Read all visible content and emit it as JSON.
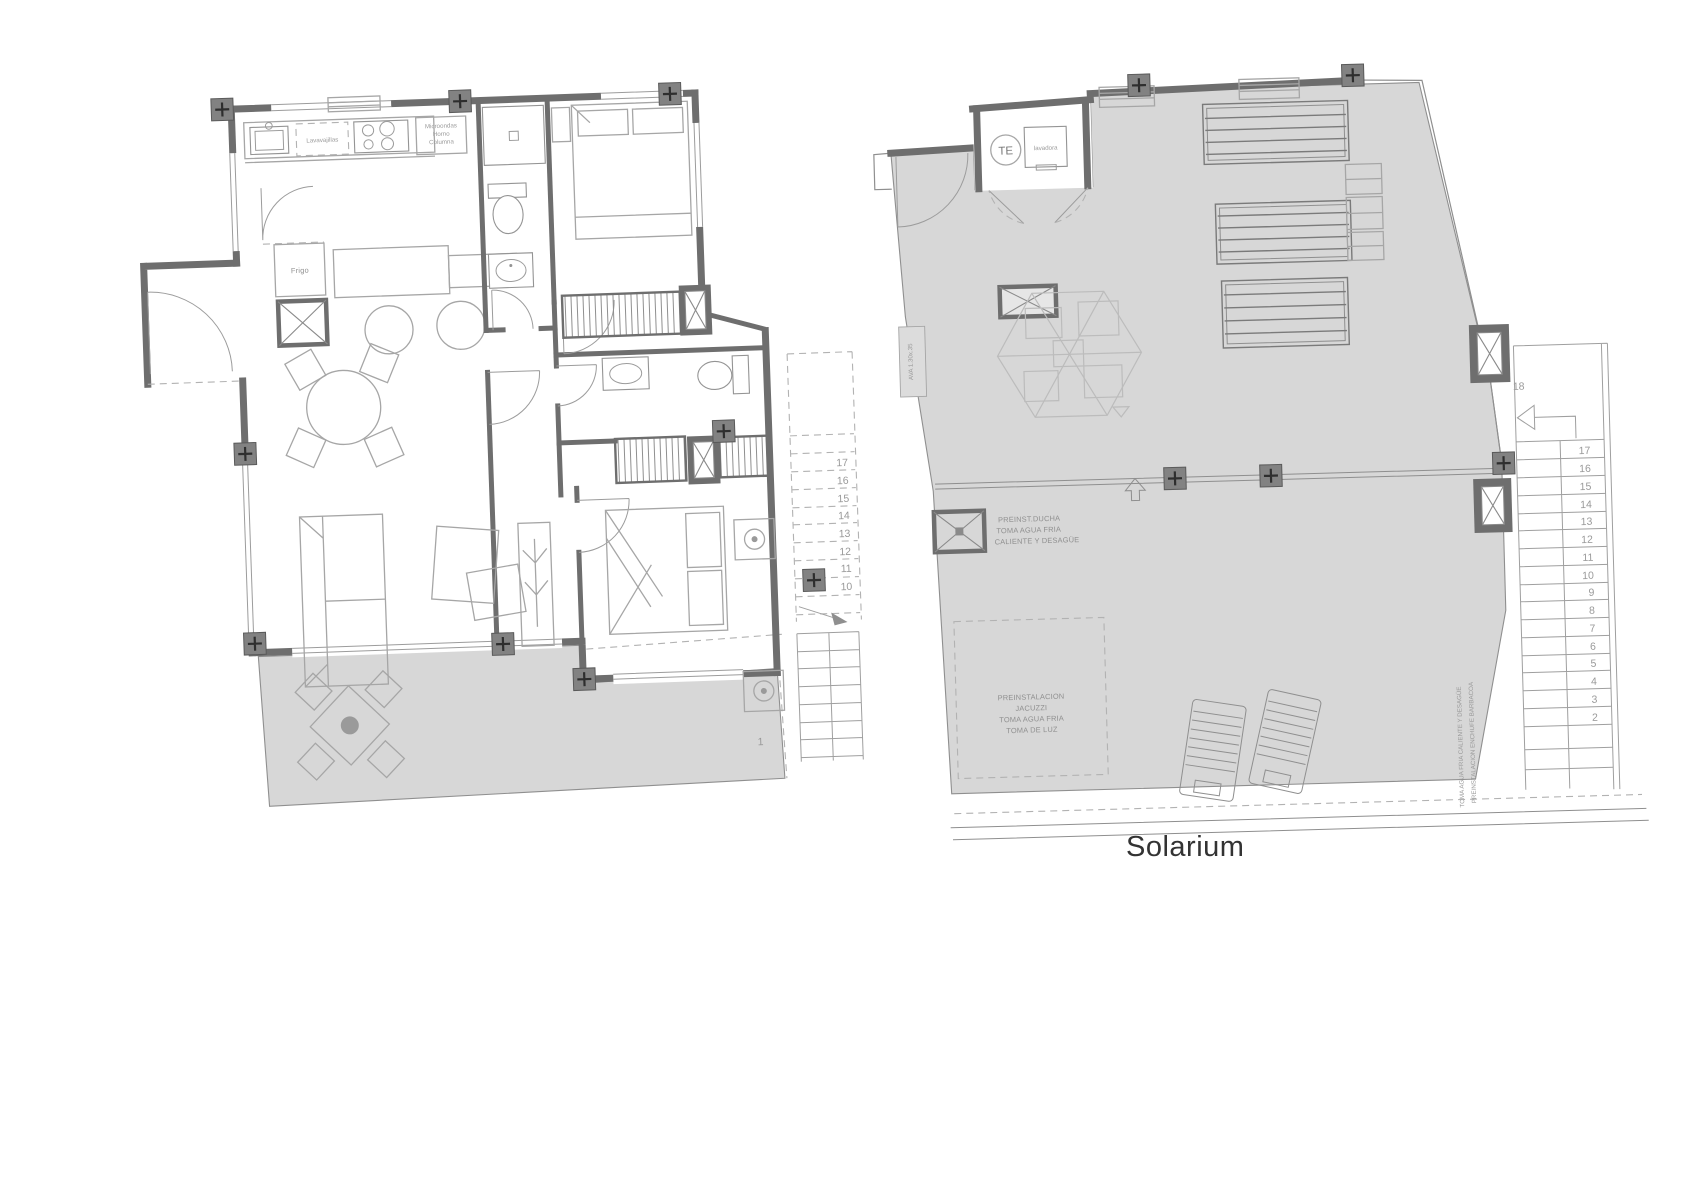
{
  "page": {
    "background": "#ffffff"
  },
  "colors": {
    "wall": "#6e6e6e",
    "furniture_line": "#a6a6a6",
    "shade": "#d7d7d7",
    "label_text": "#8f8f8f",
    "caption_text": "#333333"
  },
  "left_plan": {
    "kitchen": {
      "dishwasher": "Lavavajillas",
      "appliance_column": [
        "Microondas",
        "Horno",
        "Columna"
      ],
      "fridge": "Frigo"
    },
    "stairs": {
      "upper_numbers": [
        "17",
        "16",
        "15",
        "14",
        "13",
        "12",
        "11",
        "10"
      ],
      "lowest_number": "1"
    }
  },
  "right_plan": {
    "telecom_label": "TE",
    "washer_label": "lavadora",
    "vent_label": "AVA 1.30x.35",
    "shower_note": [
      "PREINST.DUCHA",
      "TOMA AGUA FRIA",
      "CALIENTE Y DESAGÜE"
    ],
    "jacuzzi_note": [
      "PREINSTALACION",
      "JACUZZI",
      "TOMA AGUA FRIA",
      "TOMA DE LUZ"
    ],
    "barbecue_note": [
      "TOMA AGUA FRIA CALIENTE Y DESAGÜE",
      "PREINSTALACION ENCHUFE BARBACOA"
    ],
    "stairs": {
      "top_number": "18",
      "numbers": [
        "17",
        "16",
        "15",
        "14",
        "13",
        "12",
        "11",
        "10",
        "9",
        "8",
        "7",
        "6",
        "5",
        "4",
        "3",
        "2"
      ]
    },
    "caption": "Solarium"
  }
}
